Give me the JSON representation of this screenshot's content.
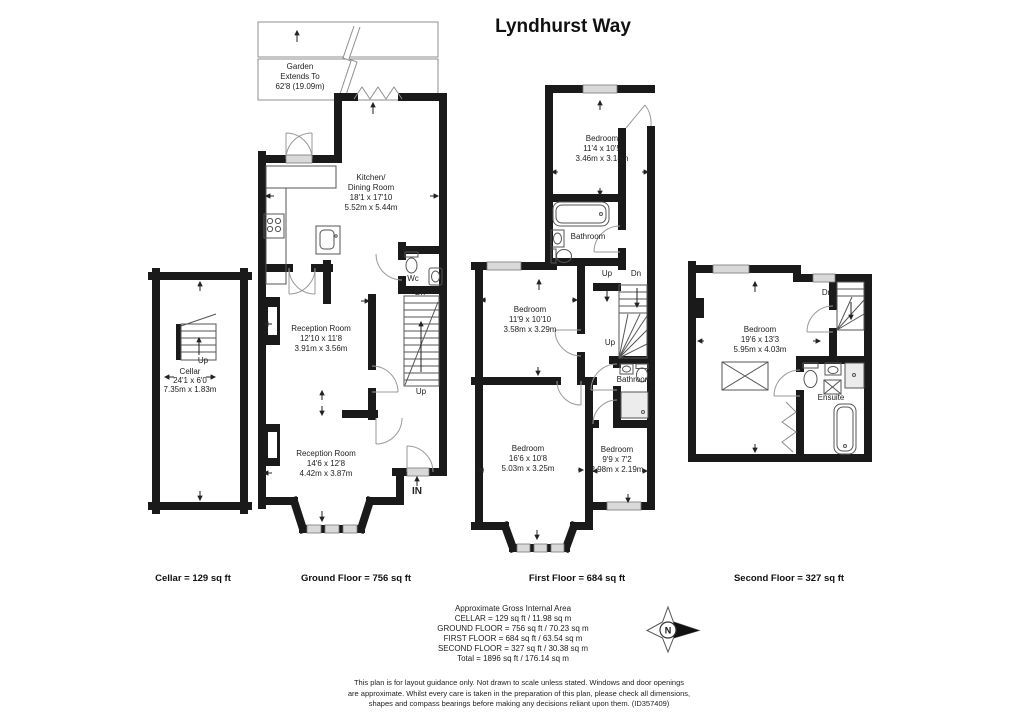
{
  "title": "Lyndhurst Way",
  "garden": {
    "l1": "Garden",
    "l2": "Extends To",
    "l3": "62'8 (19.09m)"
  },
  "labels": {
    "up": "Up",
    "dn": "Dn",
    "in": "IN",
    "wc": "Wc",
    "bathroom": "Bathroom",
    "ensuite": "Ensuite",
    "north": "N"
  },
  "rooms": {
    "cellar": {
      "name": "Cellar",
      "ft": "24'1 x 6'0",
      "m": "7.35m x 1.83m"
    },
    "kitchen": {
      "n1": "Kitchen/",
      "n2": "Dining Room",
      "ft": "18'1 x 17'10",
      "m": "5.52m x 5.44m"
    },
    "reception1": {
      "name": "Reception Room",
      "ft": "12'10 x 11'8",
      "m": "3.91m x 3.56m"
    },
    "reception2": {
      "name": "Reception Room",
      "ft": "14'6 x 12'8",
      "m": "4.42m x 3.87m"
    },
    "bedroom1": {
      "name": "Bedroom",
      "ft": "11'4 x 10'5",
      "m": "3.46m x 3.18m"
    },
    "bedroom2": {
      "name": "Bedroom",
      "ft": "11'9 x 10'10",
      "m": "3.58m x 3.29m"
    },
    "bedroom3": {
      "name": "Bedroom",
      "ft": "16'6 x 10'8",
      "m": "5.03m x 3.25m"
    },
    "bedroom4": {
      "name": "Bedroom",
      "ft": "9'9 x 7'2",
      "m": "2.98m x 2.19m"
    },
    "bedroom5": {
      "name": "Bedroom",
      "ft": "19'6 x 13'3",
      "m": "5.95m x 4.03m"
    }
  },
  "floor_labels": {
    "cellar": "Cellar = 129 sq ft",
    "ground": "Ground Floor = 756 sq ft",
    "first": "First Floor = 684 sq ft",
    "second": "Second Floor = 327 sq ft"
  },
  "area_summary": {
    "title": "Approximate Gross Internal Area",
    "lines": [
      "CELLAR = 129 sq ft / 11.98 sq m",
      "GROUND FLOOR = 756 sq ft / 70.23 sq m",
      "FIRST FLOOR = 684 sq ft / 63.54 sq m",
      "SECOND FLOOR = 327 sq ft / 30.38 sq m",
      "Total = 1896 sq ft / 176.14 sq m"
    ]
  },
  "disclaimer": {
    "l1": "This plan is for layout guidance only. Not drawn to scale unless stated. Windows and door openings",
    "l2": "are approximate. Whilst every care is taken in the preparation of this plan, please check all dimensions,",
    "l3": "shapes and compass bearings before making any decisions reliant upon them. (ID357409)"
  }
}
